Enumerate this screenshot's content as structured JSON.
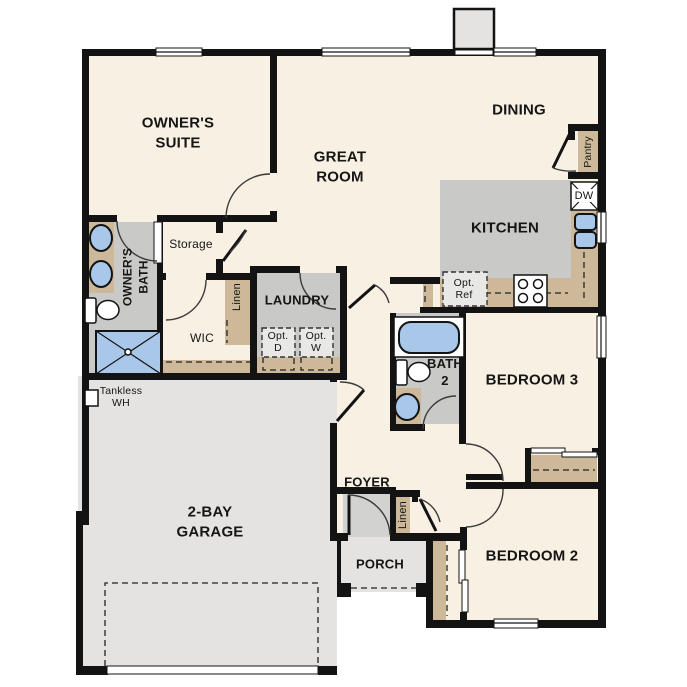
{
  "title": "Single-story floor plan",
  "colors": {
    "wall": "#131313",
    "cream": "#f8f0e2",
    "grey_floor": "#e4e3e1",
    "grey_room": "#c9c9c7",
    "grey_foyer": "#d2d2d0",
    "tan": "#cdb999",
    "blue": "#a9c7e8",
    "optbox": "#e8e8e6"
  },
  "labels": {
    "owners_suite": "OWNER'S\nSUITE",
    "great_room": "GREAT\nROOM",
    "dining": "DINING",
    "kitchen": "KITCHEN",
    "owners_bath": "OWNER'S\nBATH",
    "storage": "Storage",
    "wic": "WIC",
    "linen_wic": "Linen",
    "laundry": "LAUNDRY",
    "opt_d": "Opt.\nD",
    "opt_w": "Opt.\nW",
    "opt_ref": "Opt.\nRef",
    "dw": "DW",
    "pantry": "Pantry",
    "bath2": "BATH\n2",
    "bedroom3": "BEDROOM 3",
    "bedroom2": "BEDROOM 2",
    "foyer": "FOYER",
    "porch": "PORCH",
    "garage": "2-BAY\nGARAGE",
    "tankless": "Tankless\nWH"
  }
}
